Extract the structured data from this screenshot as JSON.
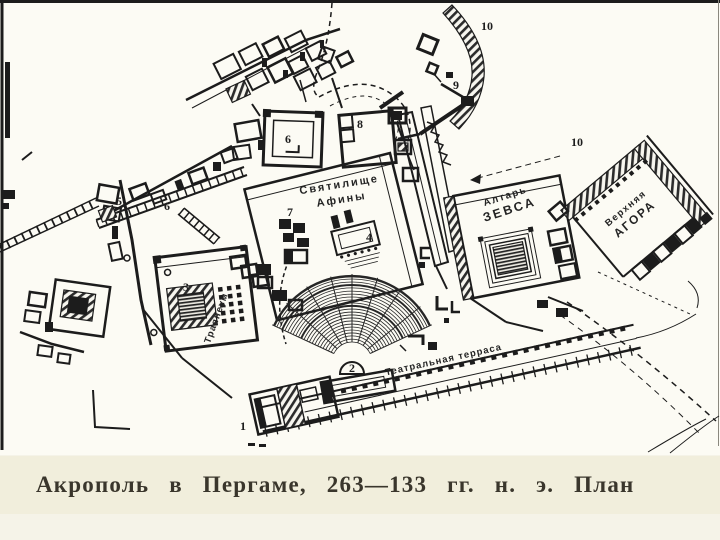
{
  "caption": {
    "text": "Акрополь в Пергаме, 263—133 гг. н. э. План"
  },
  "plan": {
    "labels": {
      "athena_line1": "Святилище",
      "athena_line2": "Афины",
      "zeus_line1": "Алтарь",
      "zeus_line2": "ЗЕВСА",
      "agora_line1": "Верхняя",
      "agora_line2": "АГОРА",
      "trajaneum": "Траянеум",
      "terrace": "Театральная терраса"
    },
    "numbers": {
      "n1": "1",
      "n2": "2",
      "n3": "3",
      "n4": "4",
      "n5": "5",
      "n6a": "6",
      "n6b": "6",
      "n7": "7",
      "n8": "8",
      "n9": "9",
      "n10_wall": "10",
      "n10_agora": "10"
    }
  },
  "colors": {
    "ink": "#1c1c1c",
    "paper": "#fcfbf4",
    "caption_bg": "#f1eedc",
    "caption_ink": "#3a362c"
  }
}
